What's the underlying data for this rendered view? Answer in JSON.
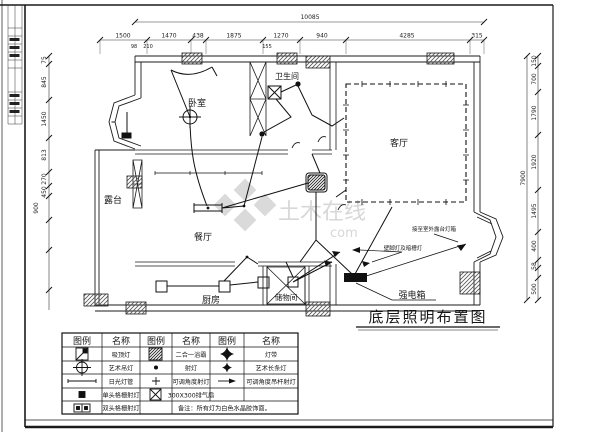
{
  "title": "底层照明布置图",
  "watermark": {
    "brand": "土木在线",
    "suffix": "com"
  },
  "rooms": {
    "bedroom": "卧室",
    "bathroom": "卫生间",
    "living": "客厅",
    "terrace": "露台",
    "dining": "餐厅",
    "kitchen": "厨房",
    "storage": "储物间",
    "power_box": "强电箱"
  },
  "annotations": {
    "terrace_lightbox": "接至室外露台灯箱",
    "wall_lamp": "壁脚灯及暗槽灯"
  },
  "dimensions": {
    "top_overall": "10085",
    "top": [
      "1500",
      "1470",
      "438",
      "1875",
      "1270",
      "940",
      "4285",
      "315"
    ],
    "top_sub": [
      "98",
      "210",
      "155"
    ],
    "left": [
      "75",
      "845",
      "1450",
      "813",
      "270",
      "450",
      "900"
    ],
    "right_overall": "7900",
    "right": [
      "150",
      "700",
      "1790",
      "1920",
      "1495",
      "400",
      "58",
      "500"
    ]
  },
  "legend": {
    "headers": [
      "图例",
      "名称",
      "图例",
      "名称",
      "图例",
      "名称"
    ],
    "rows": [
      [
        "吸顶灯",
        "二合一浴霸",
        "灯带"
      ],
      [
        "艺术吊灯",
        "射灯",
        "艺术长条灯"
      ],
      [
        "日光灯管",
        "可调角度射灯",
        "可调角度吊杆射灯"
      ],
      [
        "单头格栅射灯",
        "300X300排气扇",
        ""
      ],
      [
        "双头格栅射灯",
        "",
        ""
      ]
    ],
    "note": "备注：所有灯为白色水晶胶饰面。"
  }
}
